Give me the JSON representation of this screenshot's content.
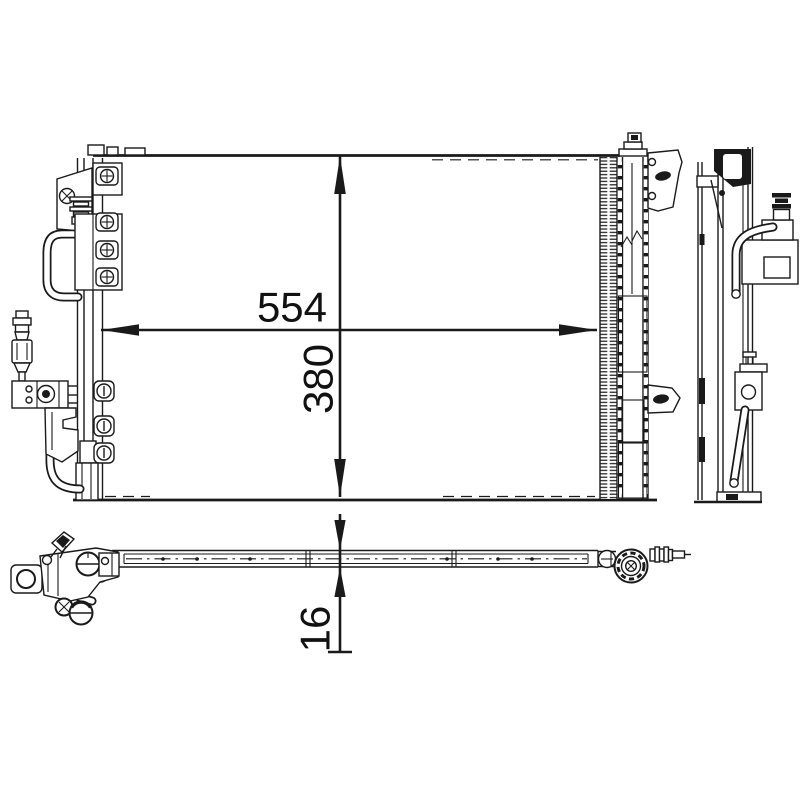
{
  "canvas": {
    "background": "#ffffff",
    "line_color": "#1a1a1a"
  },
  "dimensions": {
    "width": "554",
    "height": "380",
    "thickness": "16"
  }
}
